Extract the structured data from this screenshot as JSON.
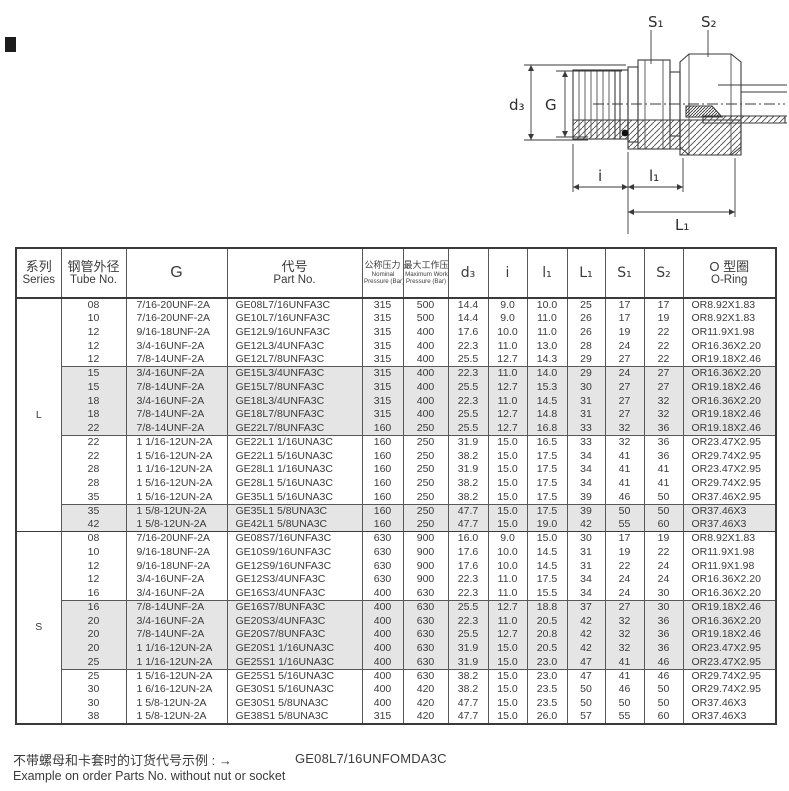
{
  "colors": {
    "shaded_row": "#e5e5e5",
    "border": "#585858",
    "outer_border": "#3a3a3a",
    "text": "#3b3b3b"
  },
  "drawing": {
    "labels": {
      "s1": "S₁",
      "s2": "S₂",
      "d3": "d₃",
      "g": "G",
      "i": "i",
      "l1": "l₁",
      "L1": "L₁"
    }
  },
  "table": {
    "headers": {
      "series_zh": "系列",
      "series_en": "Series",
      "tube_zh": "钢管外径",
      "tube_en": "Tube No.",
      "g": "G",
      "part_zh": "代号",
      "part_en": "Part No.",
      "nominal_zh": "公称压力",
      "nominal_en1": "Nominal",
      "nominal_en2": "Pressure (Bar)",
      "max_zh": "最大工作压力",
      "max_en1": "Maximum Working",
      "max_en2": "Pressure (Bar)",
      "d3": "d₃",
      "i": "i",
      "l1": "l₁",
      "L1": "L₁",
      "S1": "S₁",
      "S2": "S₂",
      "oring_zh": "O 型圈",
      "oring_en": "O-Ring"
    },
    "sections": [
      {
        "series": "L",
        "blocks": [
          {
            "shaded": false,
            "rows": [
              [
                "08",
                "7/16-20UNF-2A",
                "GE08L7/16UNFA3C",
                "315",
                "500",
                "14.4",
                "9.0",
                "10.0",
                "25",
                "17",
                "17",
                "OR8.92X1.83"
              ],
              [
                "10",
                "7/16-20UNF-2A",
                "GE10L7/16UNFA3C",
                "315",
                "500",
                "14.4",
                "9.0",
                "11.0",
                "26",
                "17",
                "19",
                "OR8.92X1.83"
              ],
              [
                "12",
                "9/16-18UNF-2A",
                "GE12L9/16UNFA3C",
                "315",
                "400",
                "17.6",
                "10.0",
                "11.0",
                "26",
                "19",
                "22",
                "OR11.9X1.98"
              ],
              [
                "12",
                "3/4-16UNF-2A",
                "GE12L3/4UNFA3C",
                "315",
                "400",
                "22.3",
                "11.0",
                "13.0",
                "28",
                "24",
                "22",
                "OR16.36X2.20"
              ],
              [
                "12",
                "7/8-14UNF-2A",
                "GE12L7/8UNFA3C",
                "315",
                "400",
                "25.5",
                "12.7",
                "14.3",
                "29",
                "27",
                "22",
                "OR19.18X2.46"
              ]
            ]
          },
          {
            "shaded": true,
            "rows": [
              [
                "15",
                "3/4-16UNF-2A",
                "GE15L3/4UNFA3C",
                "315",
                "400",
                "22.3",
                "11.0",
                "14.0",
                "29",
                "24",
                "27",
                "OR16.36X2.20"
              ],
              [
                "15",
                "7/8-14UNF-2A",
                "GE15L7/8UNFA3C",
                "315",
                "400",
                "25.5",
                "12.7",
                "15.3",
                "30",
                "27",
                "27",
                "OR19.18X2.46"
              ],
              [
                "18",
                "3/4-16UNF-2A",
                "GE18L3/4UNFA3C",
                "315",
                "400",
                "22.3",
                "11.0",
                "14.5",
                "31",
                "27",
                "32",
                "OR16.36X2.20"
              ],
              [
                "18",
                "7/8-14UNF-2A",
                "GE18L7/8UNFA3C",
                "315",
                "400",
                "25.5",
                "12.7",
                "14.8",
                "31",
                "27",
                "32",
                "OR19.18X2.46"
              ],
              [
                "22",
                "7/8-14UNF-2A",
                "GE22L7/8UNFA3C",
                "160",
                "250",
                "25.5",
                "12.7",
                "16.8",
                "33",
                "32",
                "36",
                "OR19.18X2.46"
              ]
            ]
          },
          {
            "shaded": false,
            "rows": [
              [
                "22",
                "1 1/16-12UN-2A",
                "GE22L1 1/16UNA3C",
                "160",
                "250",
                "31.9",
                "15.0",
                "16.5",
                "33",
                "32",
                "36",
                "OR23.47X2.95"
              ],
              [
                "22",
                "1 5/16-12UN-2A",
                "GE22L1 5/16UNA3C",
                "160",
                "250",
                "38.2",
                "15.0",
                "17.5",
                "34",
                "41",
                "36",
                "OR29.74X2.95"
              ],
              [
                "28",
                "1 1/16-12UN-2A",
                "GE28L1 1/16UNA3C",
                "160",
                "250",
                "31.9",
                "15.0",
                "17.5",
                "34",
                "41",
                "41",
                "OR23.47X2.95"
              ],
              [
                "28",
                "1 5/16-12UN-2A",
                "GE28L1 5/16UNA3C",
                "160",
                "250",
                "38.2",
                "15.0",
                "17.5",
                "34",
                "41",
                "41",
                "OR29.74X2.95"
              ],
              [
                "35",
                "1 5/16-12UN-2A",
                "GE35L1 5/16UNA3C",
                "160",
                "250",
                "38.2",
                "15.0",
                "17.5",
                "39",
                "46",
                "50",
                "OR37.46X2.95"
              ]
            ]
          },
          {
            "shaded": true,
            "rows": [
              [
                "35",
                "1 5/8-12UN-2A",
                "GE35L1 5/8UNA3C",
                "160",
                "250",
                "47.7",
                "15.0",
                "17.5",
                "39",
                "50",
                "50",
                "OR37.46X3"
              ],
              [
                "42",
                "1 5/8-12UN-2A",
                "GE42L1 5/8UNA3C",
                "160",
                "250",
                "47.7",
                "15.0",
                "19.0",
                "42",
                "55",
                "60",
                "OR37.46X3"
              ]
            ]
          }
        ]
      },
      {
        "series": "S",
        "blocks": [
          {
            "shaded": false,
            "rows": [
              [
                "08",
                "7/16-20UNF-2A",
                "GE08S7/16UNFA3C",
                "630",
                "900",
                "16.0",
                "9.0",
                "15.0",
                "30",
                "17",
                "19",
                "OR8.92X1.83"
              ],
              [
                "10",
                "9/16-18UNF-2A",
                "GE10S9/16UNFA3C",
                "630",
                "900",
                "17.6",
                "10.0",
                "14.5",
                "31",
                "19",
                "22",
                "OR11.9X1.98"
              ],
              [
                "12",
                "9/16-18UNF-2A",
                "GE12S9/16UNFA3C",
                "630",
                "900",
                "17.6",
                "10.0",
                "14.5",
                "31",
                "22",
                "24",
                "OR11.9X1.98"
              ],
              [
                "12",
                "3/4-16UNF-2A",
                "GE12S3/4UNFA3C",
                "630",
                "900",
                "22.3",
                "11.0",
                "17.5",
                "34",
                "24",
                "24",
                "OR16.36X2.20"
              ],
              [
                "16",
                "3/4-16UNF-2A",
                "GE16S3/4UNFA3C",
                "400",
                "630",
                "22.3",
                "11.0",
                "15.5",
                "34",
                "24",
                "30",
                "OR16.36X2.20"
              ]
            ]
          },
          {
            "shaded": true,
            "rows": [
              [
                "16",
                "7/8-14UNF-2A",
                "GE16S7/8UNFA3C",
                "400",
                "630",
                "25.5",
                "12.7",
                "18.8",
                "37",
                "27",
                "30",
                "OR19.18X2.46"
              ],
              [
                "20",
                "3/4-16UNF-2A",
                "GE20S3/4UNFA3C",
                "400",
                "630",
                "22.3",
                "11.0",
                "20.5",
                "42",
                "32",
                "36",
                "OR16.36X2.20"
              ],
              [
                "20",
                "7/8-14UNF-2A",
                "GE20S7/8UNFA3C",
                "400",
                "630",
                "25.5",
                "12.7",
                "20.8",
                "42",
                "32",
                "36",
                "OR19.18X2.46"
              ],
              [
                "20",
                "1 1/16-12UN-2A",
                "GE20S1 1/16UNA3C",
                "400",
                "630",
                "31.9",
                "15.0",
                "20.5",
                "42",
                "32",
                "36",
                "OR23.47X2.95"
              ],
              [
                "25",
                "1 1/16-12UN-2A",
                "GE25S1 1/16UNA3C",
                "400",
                "630",
                "31.9",
                "15.0",
                "23.0",
                "47",
                "41",
                "46",
                "OR23.47X2.95"
              ]
            ]
          },
          {
            "shaded": false,
            "rows": [
              [
                "25",
                "1 5/16-12UN-2A",
                "GE25S1 5/16UNA3C",
                "400",
                "630",
                "38.2",
                "15.0",
                "23.0",
                "47",
                "41",
                "46",
                "OR29.74X2.95"
              ],
              [
                "30",
                "1 6/16-12UN-2A",
                "GE30S1 5/16UNA3C",
                "400",
                "420",
                "38.2",
                "15.0",
                "23.5",
                "50",
                "46",
                "50",
                "OR29.74X2.95"
              ],
              [
                "30",
                "1 5/8-12UN-2A",
                "GE30S1 5/8UNA3C",
                "400",
                "420",
                "47.7",
                "15.0",
                "23.5",
                "50",
                "50",
                "50",
                "OR37.46X3"
              ],
              [
                "38",
                "1 5/8-12UN-2A",
                "GE38S1 5/8UNA3C",
                "315",
                "420",
                "47.7",
                "15.0",
                "26.0",
                "57",
                "55",
                "60",
                "OR37.46X3"
              ]
            ]
          }
        ]
      }
    ]
  },
  "footer": {
    "note_zh": "不带螺母和卡套时的订货代号示例 : ",
    "arrow": "→",
    "example_part": "GE08L7/16UNFOMDA3C",
    "note_en": "Example on order Parts No. without nut or socket"
  }
}
